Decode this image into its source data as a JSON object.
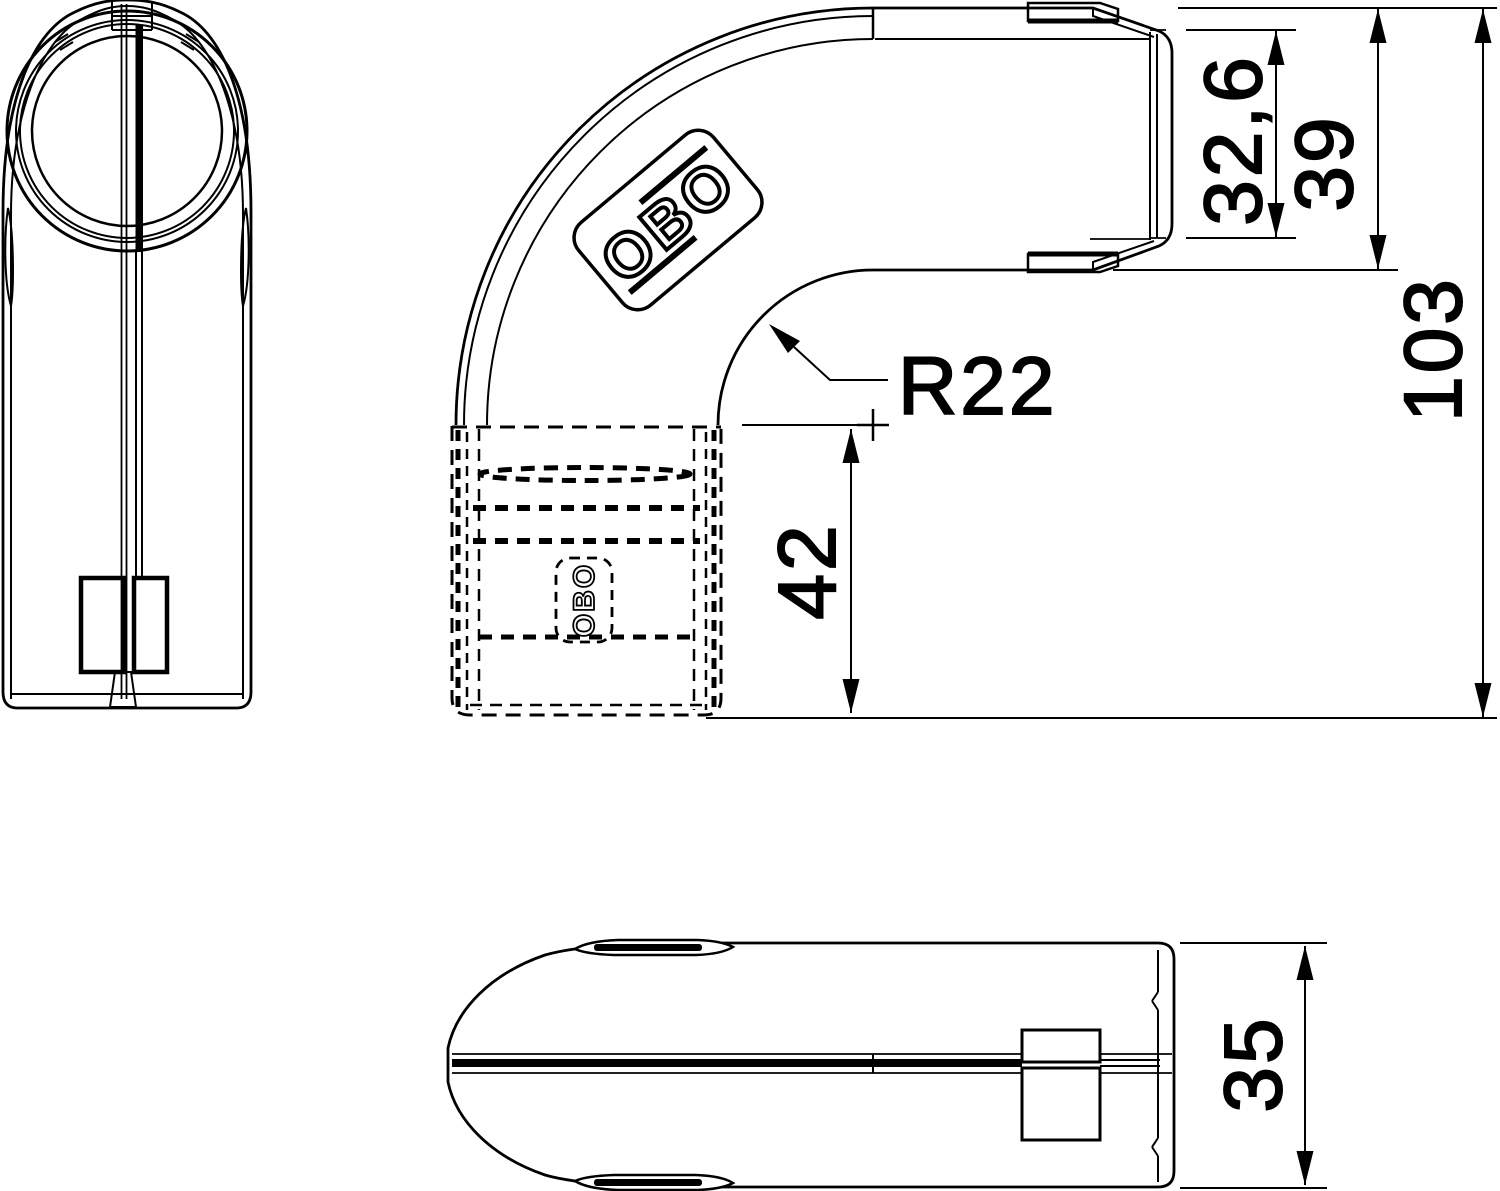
{
  "drawing": {
    "type": "technical-dimension-drawing",
    "part": "pipe bend fitting",
    "background_color": "#ffffff",
    "line_color": "#000000"
  },
  "logo": {
    "brand": "OBO",
    "brand_small": "OBO"
  },
  "dimensions": {
    "socket_opening": "32,6",
    "end_height": "39",
    "overall_height": "103",
    "bend_radius": "R22",
    "socket_length": "42",
    "width": "35"
  }
}
